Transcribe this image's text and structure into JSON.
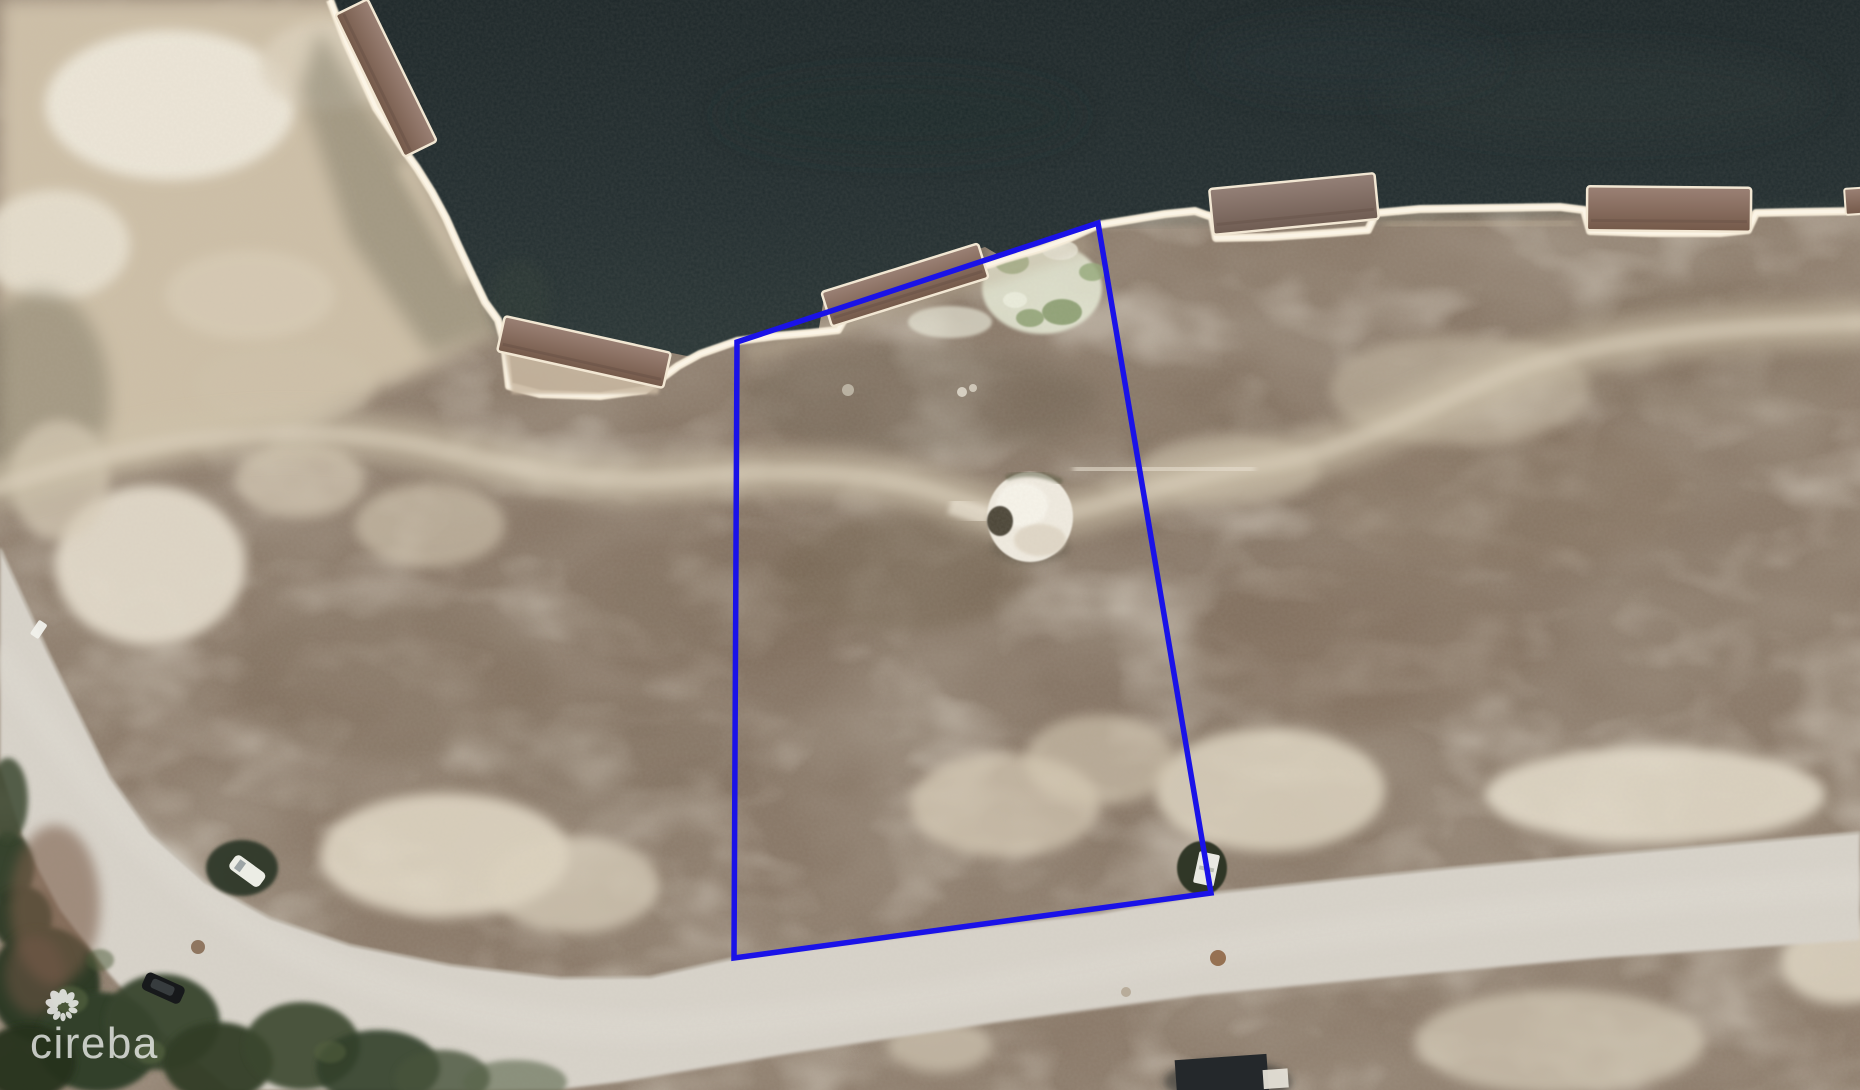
{
  "scene": {
    "type": "aerial-satellite-photo",
    "description": "Vacant canal-front land parcel outlined in blue; dark waterway with seawall and boat docks at top, brown scrub lot in middle, curving light gravel road at bottom, trees bottom-left",
    "water_color": "#212c2e",
    "land_color": "#8b7a69",
    "road_color": "#d8d3ca",
    "seawall_color": "#f6ecd9",
    "dock_color": "#86695b",
    "tree_color": "#333f2a",
    "features": [
      "waterway",
      "seawall",
      "boat-docks",
      "vacant-lot",
      "scrub-land",
      "sand-trail",
      "white-sand-mound",
      "gravel-road",
      "trees",
      "parked-cars",
      "utility-box"
    ]
  },
  "parcel": {
    "points": "737,342 1098,223 1211,893 734,958",
    "color": "#1A12E8",
    "stroke_width": 5.5
  },
  "watermark": {
    "brand": "cireba",
    "icon": "flower-petal-swirl",
    "color": "#ffffff",
    "opacity": 0.72
  }
}
